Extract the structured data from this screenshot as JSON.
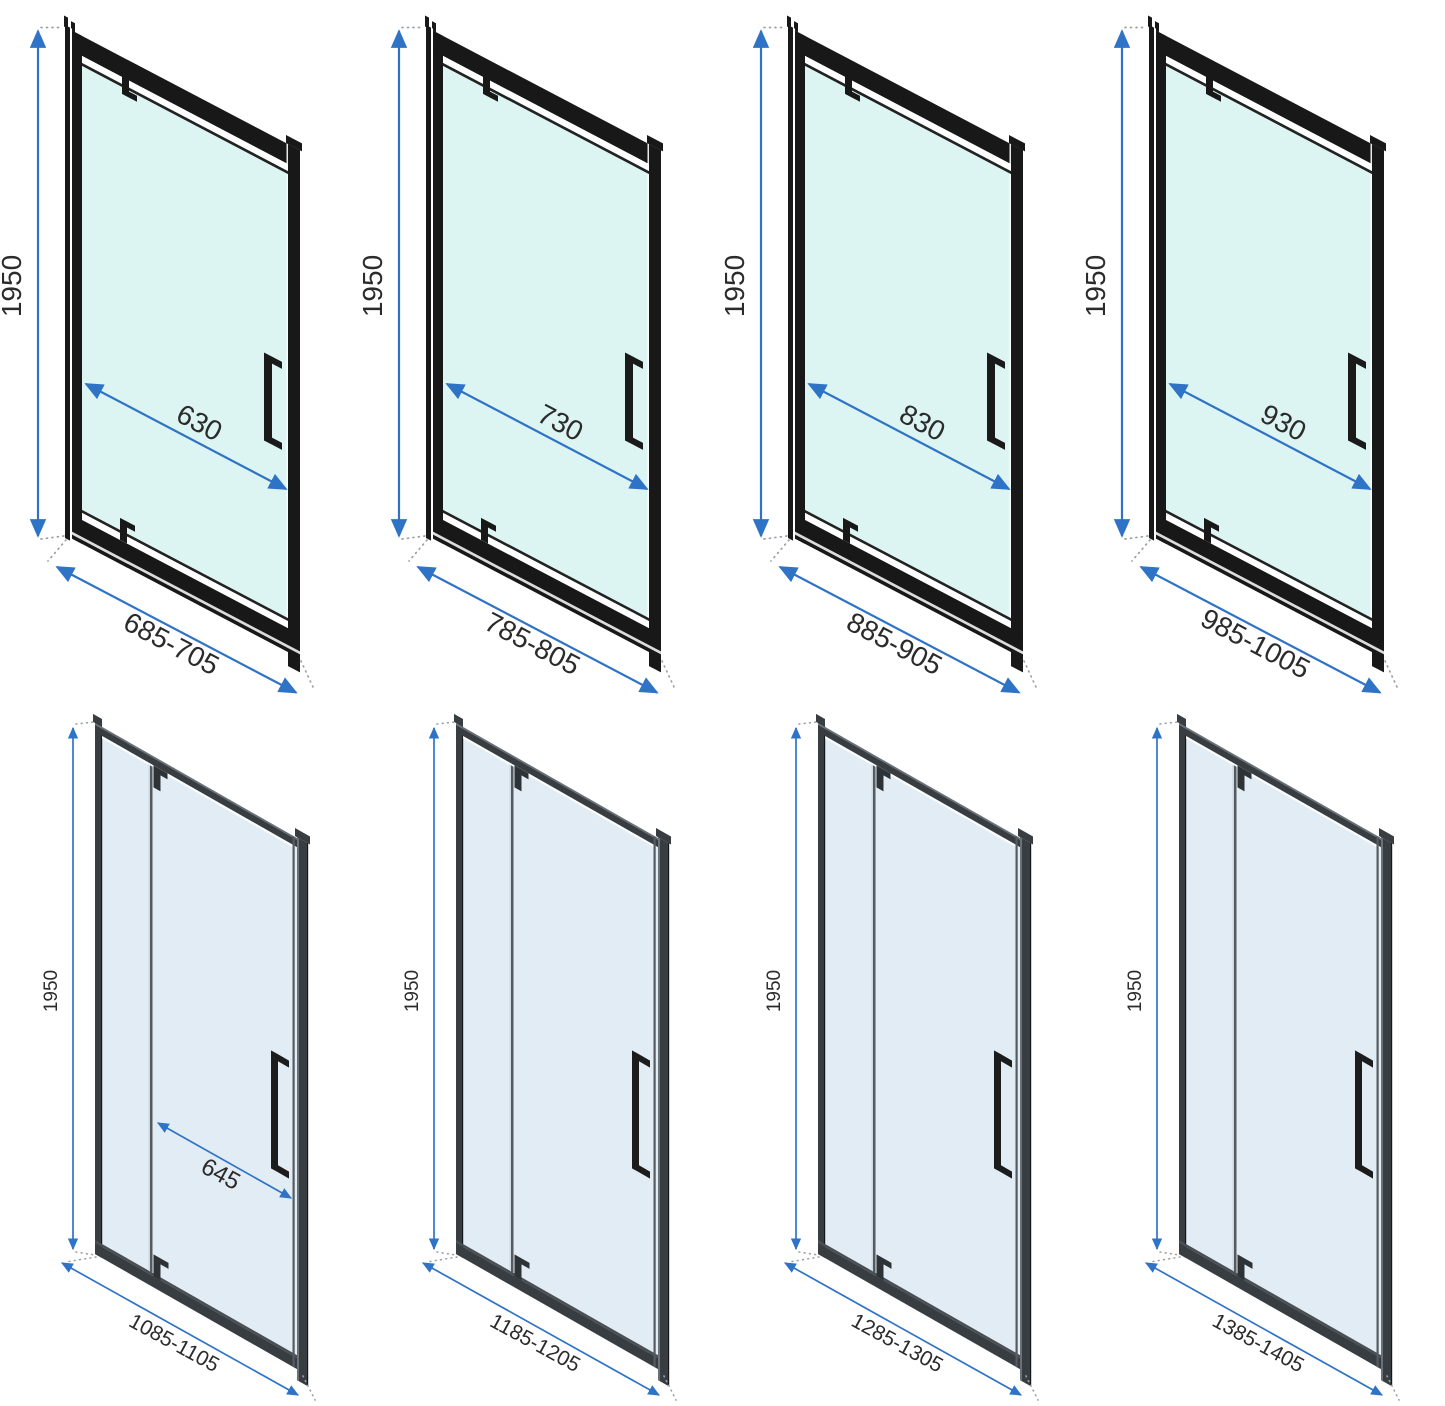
{
  "page": {
    "description_labels": {
      "drawing_type": "shower-door-dimension-diagrams"
    },
    "background": "#ffffff"
  },
  "colors": {
    "dimension_blue": "#2f73c6",
    "frame_black": "#181818",
    "frame_dark_gray": "#383d42",
    "frame_edge_light": "#6b7178",
    "glass_top_row": "#dcf4f2",
    "glass_bottom_row": "#e2ecf4",
    "divider_gray": "#555b61",
    "label_text": "#2b2b2b",
    "dotted_leader_gray": "#9aa0a6"
  },
  "doors": {
    "top_row": [
      {
        "height_label": "1950",
        "inner_width_label": "630",
        "range_label": "685-705"
      },
      {
        "height_label": "1950",
        "inner_width_label": "730",
        "range_label": "785-805"
      },
      {
        "height_label": "1950",
        "inner_width_label": "830",
        "range_label": "885-905"
      },
      {
        "height_label": "1950",
        "inner_width_label": "930",
        "range_label": "985-1005"
      }
    ],
    "bottom_row": [
      {
        "height_label": "1950",
        "inner_width_label": "645",
        "range_label": "1085-1105"
      },
      {
        "height_label": "1950",
        "range_label": "1185-1205"
      },
      {
        "height_label": "1950",
        "range_label": "1285-1305"
      },
      {
        "height_label": "1950",
        "range_label": "1385-1405"
      }
    ]
  }
}
